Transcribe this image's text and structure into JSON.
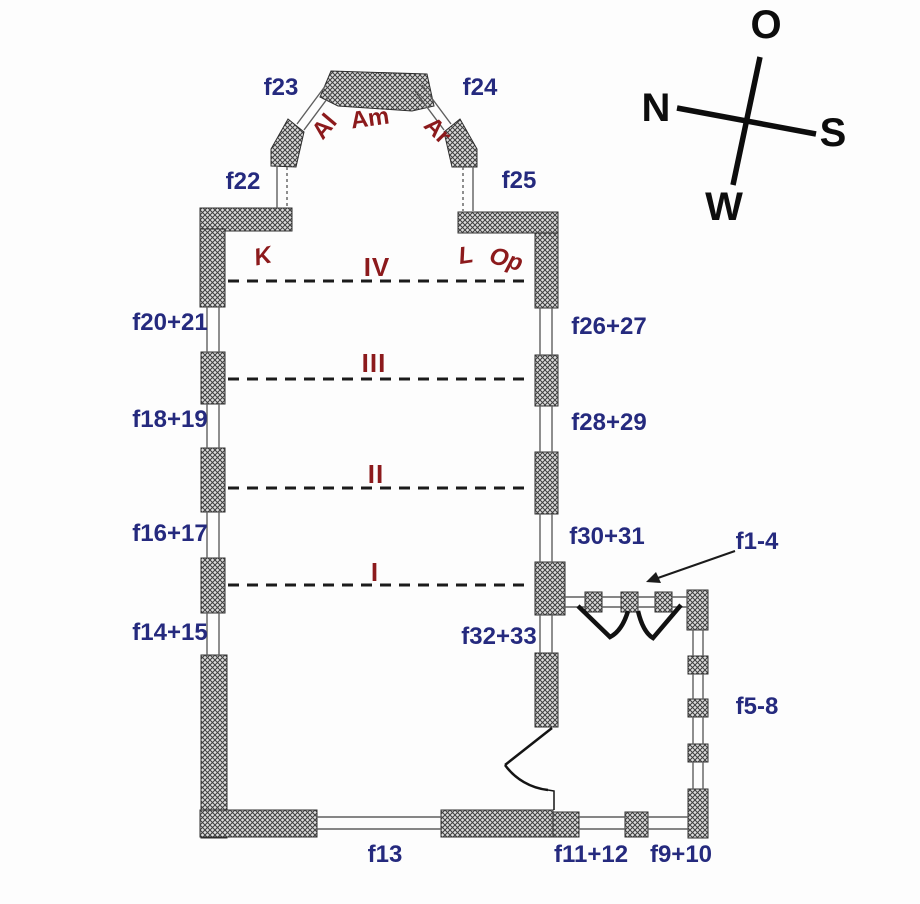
{
  "figure": {
    "kind": "church floor plan with numbered window labels, bay numbers and compass rose"
  },
  "colors": {
    "label_blue": "#252A7E",
    "label_red": "#8C1A1C",
    "wall_hatch": "#3F3F3F",
    "line_black": "#1B1B1B",
    "background": "#FDFDFD"
  },
  "compass": {
    "east": "O",
    "north": "N",
    "south": "S",
    "west": "W"
  },
  "bays": {
    "b1": "I",
    "b2": "II",
    "b3": "III",
    "b4": "IV"
  },
  "zones": {
    "al": "Al",
    "am": "Am",
    "ar": "Ar",
    "k": "K",
    "l": "L",
    "op": "Op"
  },
  "windows": {
    "f1_4": "f1-4",
    "f5_8": "f5-8",
    "f9_10": "f9+10",
    "f11_12": "f11+12",
    "f13": "f13",
    "f14_15": "f14+15",
    "f16_17": "f16+17",
    "f18_19": "f18+19",
    "f20_21": "f20+21",
    "f22": "f22",
    "f23": "f23",
    "f24": "f24",
    "f25": "f25",
    "f26_27": "f26+27",
    "f28_29": "f28+29",
    "f30_31": "f30+31",
    "f32_33": "f32+33"
  }
}
